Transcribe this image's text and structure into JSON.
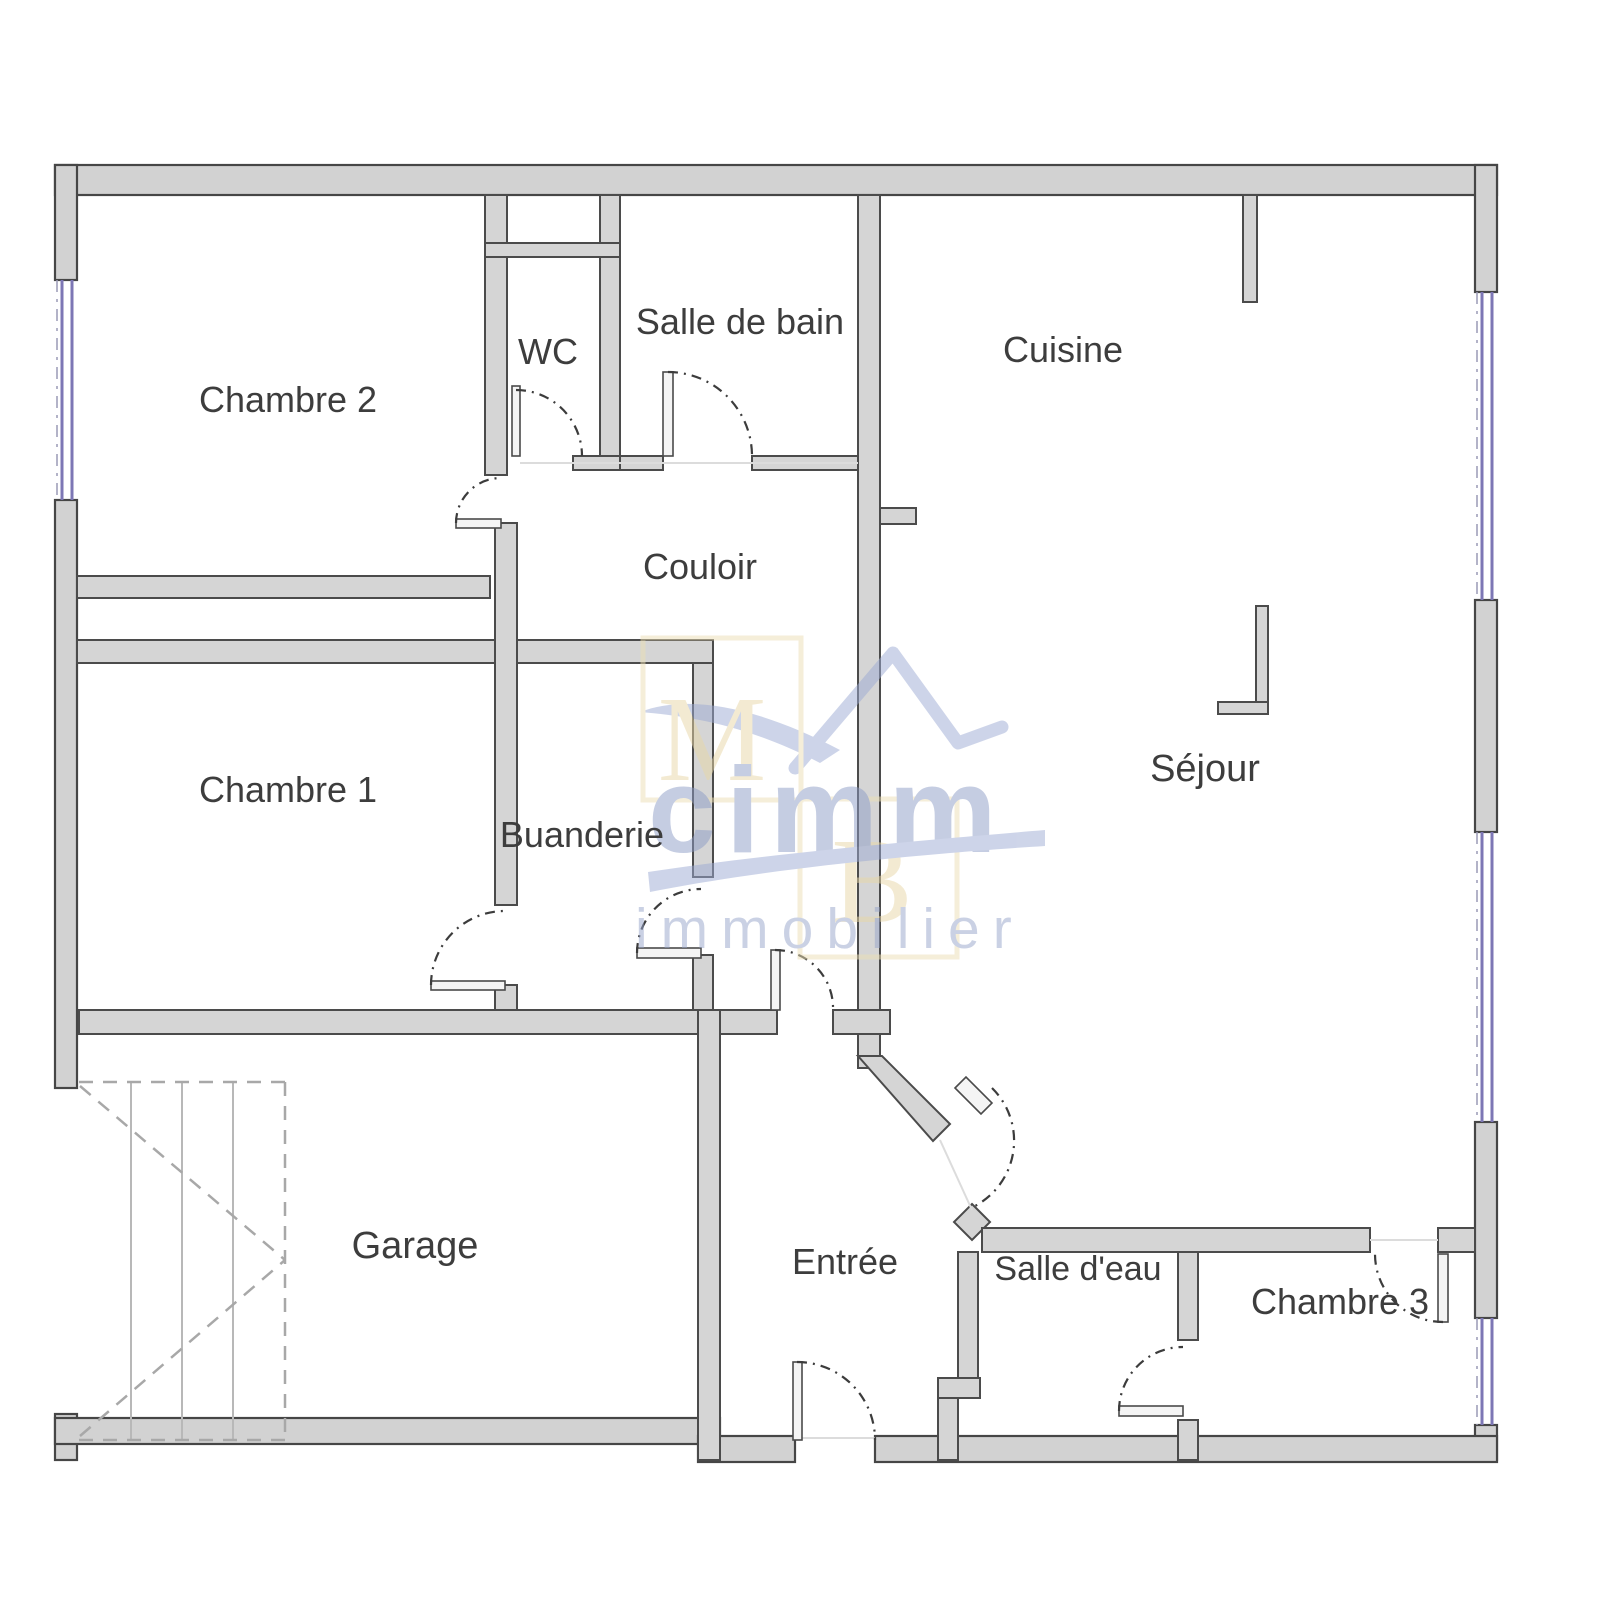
{
  "rooms": {
    "chambre2": "Chambre 2",
    "wc": "WC",
    "salle_de_bain": "Salle de bain",
    "cuisine": "Cuisine",
    "couloir": "Couloir",
    "chambre1": "Chambre 1",
    "buanderie": "Buanderie",
    "sejour": "Séjour",
    "garage": "Garage",
    "entree": "Entrée",
    "salle_deau": "Salle d'eau",
    "chambre3": "Chambre 3"
  },
  "watermark": {
    "monogram_m": "M",
    "monogram_b": "B",
    "brand": "cimm",
    "brand_sub": "immobilier"
  },
  "colors": {
    "background": "#ffffff",
    "wall_fill": "#d5d5d5",
    "wall_stroke": "#4b4b4b",
    "window": "#7d77b5",
    "door_arc": "#3c3c3c",
    "stairs": "#a8a8a8",
    "label_text": "#3d3d3d",
    "watermark_beige": "#ecdfb4",
    "watermark_blue": "#9dabd4"
  },
  "icons": {
    "door": "quarter-arc-door",
    "window": "double-line-window",
    "stairs": "dashed-stairs"
  }
}
